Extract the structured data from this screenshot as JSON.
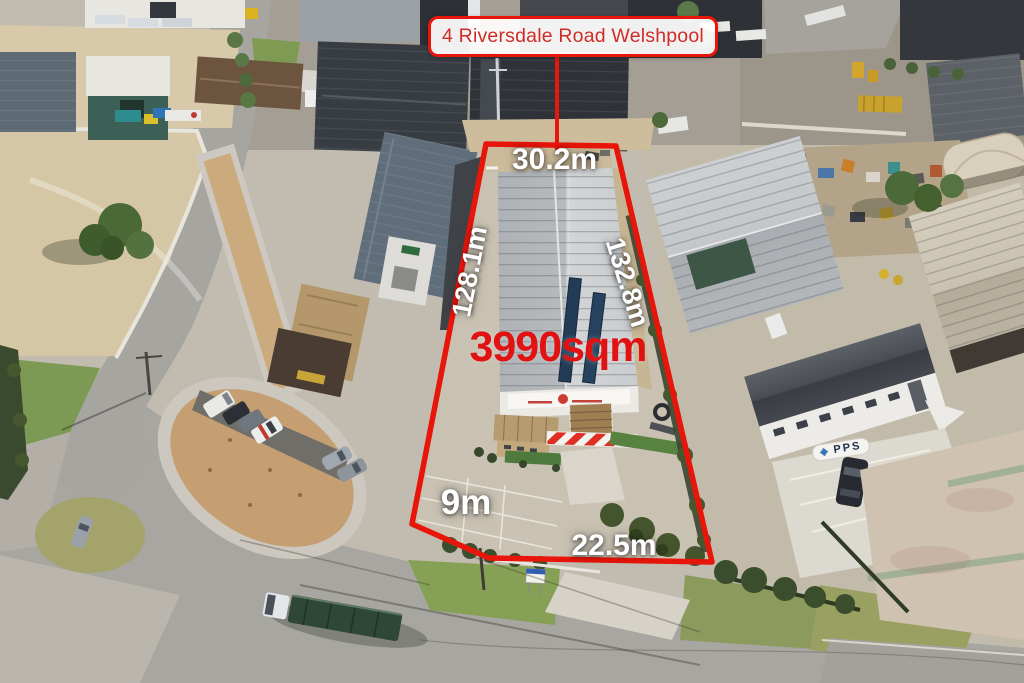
{
  "overlay": {
    "address_pill": "4 Riversdale Road Welshpool",
    "area": "3990sqm",
    "dim_top": "30.2m",
    "dim_left": "128.1m",
    "dim_right": "132.8m",
    "dim_bottom_left": "9m",
    "dim_bottom": "22.5m"
  },
  "scene": {
    "pps_sign": "PPS"
  },
  "colors": {
    "boundary-red": "#e8150b",
    "pill-text-red": "#d02d27",
    "area-red": "#e11312",
    "dim-white": "#ffffff"
  }
}
